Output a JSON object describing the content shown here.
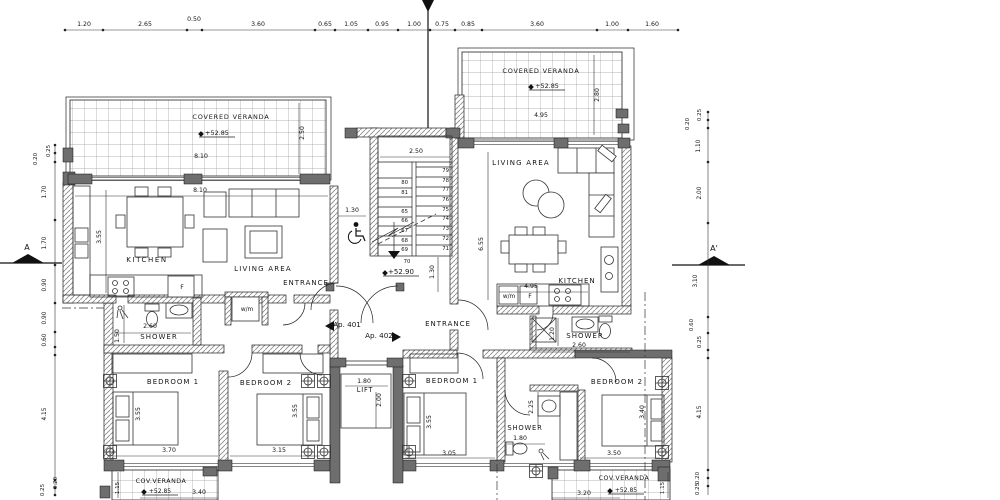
{
  "plan": {
    "type": "apartment-floor-plan",
    "apartment_left": "Ap. 401",
    "apartment_right": "Ap. 402",
    "section_marker_left": "A",
    "section_marker_right": "A'"
  },
  "stairs": {
    "left": [
      "80",
      "81",
      "65",
      "66",
      "67",
      "68",
      "69"
    ],
    "right": [
      "79",
      "78",
      "77",
      "76",
      "75",
      "74",
      "73",
      "72",
      "71"
    ],
    "bottom_step": "70"
  },
  "chains": {
    "top": {
      "y": 30,
      "x1": 65,
      "x2": 678,
      "dots": [
        65,
        103,
        187,
        202,
        315,
        335,
        368,
        398,
        430,
        455,
        482,
        597,
        628,
        678
      ]
    },
    "left": {
      "x": 55,
      "y1": 145,
      "y2": 496,
      "dots": [
        145,
        153,
        162,
        220,
        265,
        303,
        332,
        347,
        355,
        480,
        488,
        495
      ]
    },
    "right": {
      "x": 708,
      "y1": 112,
      "y2": 495,
      "dots": [
        112,
        120,
        128,
        162,
        223,
        317,
        333,
        350,
        358,
        470,
        478,
        486
      ]
    }
  },
  "labels": [
    {
      "t": "1.20",
      "x": 84,
      "y": 26
    },
    {
      "t": "2.65",
      "x": 145,
      "y": 26
    },
    {
      "t": "0.50",
      "x": 194,
      "y": 21
    },
    {
      "t": "3.60",
      "x": 258,
      "y": 26
    },
    {
      "t": "0.65",
      "x": 325,
      "y": 26
    },
    {
      "t": "1.05",
      "x": 351,
      "y": 26
    },
    {
      "t": "0.95",
      "x": 382,
      "y": 26
    },
    {
      "t": "1.00",
      "x": 414,
      "y": 26
    },
    {
      "t": "0.75",
      "x": 442,
      "y": 26
    },
    {
      "t": "0.85",
      "x": 468,
      "y": 26
    },
    {
      "t": "3.60",
      "x": 537,
      "y": 26
    },
    {
      "t": "1.00",
      "x": 612,
      "y": 26
    },
    {
      "t": "1.60",
      "x": 652,
      "y": 26
    },
    {
      "t": "0.25",
      "x": 50,
      "y": 151,
      "r": 1,
      "fs": 5.5
    },
    {
      "t": "0.20",
      "x": 37,
      "y": 159,
      "r": 1,
      "fs": 5.5
    },
    {
      "t": "1.70",
      "x": 46,
      "y": 192,
      "r": 1,
      "fs": 5.8
    },
    {
      "t": "1.70",
      "x": 46,
      "y": 243,
      "r": 1,
      "fs": 5.8
    },
    {
      "t": "0.90",
      "x": 46,
      "y": 285,
      "r": 1,
      "fs": 5.8
    },
    {
      "t": "0.90",
      "x": 46,
      "y": 318,
      "r": 1,
      "fs": 5.8
    },
    {
      "t": "0.60",
      "x": 46,
      "y": 340,
      "r": 1,
      "fs": 5.8
    },
    {
      "t": "4.15",
      "x": 46,
      "y": 414,
      "r": 1,
      "fs": 5.8
    },
    {
      "t": "0.20",
      "x": 57,
      "y": 483,
      "r": 1,
      "fs": 5.5
    },
    {
      "t": "0.25",
      "x": 44,
      "y": 490,
      "r": 1,
      "fs": 5.5
    },
    {
      "t": "0.25",
      "x": 701,
      "y": 115,
      "r": 1,
      "fs": 5.5
    },
    {
      "t": "0.20",
      "x": 689,
      "y": 124,
      "r": 1,
      "fs": 5.5
    },
    {
      "t": "1.10",
      "x": 700,
      "y": 146,
      "r": 1,
      "fs": 5.8
    },
    {
      "t": "2.00",
      "x": 701,
      "y": 193,
      "r": 1,
      "fs": 5.8
    },
    {
      "t": "3.10",
      "x": 697,
      "y": 281,
      "r": 1,
      "fs": 5.8
    },
    {
      "t": "0.60",
      "x": 693,
      "y": 325,
      "r": 1,
      "fs": 5.5
    },
    {
      "t": "0.25",
      "x": 701,
      "y": 342,
      "r": 1,
      "fs": 5.5
    },
    {
      "t": "4.15",
      "x": 701,
      "y": 412,
      "r": 1,
      "fs": 5.8
    },
    {
      "t": "0.20",
      "x": 699,
      "y": 478,
      "r": 1,
      "fs": 5.5
    },
    {
      "t": "0.25",
      "x": 699,
      "y": 489,
      "r": 1,
      "fs": 5.5
    },
    {
      "t": "A",
      "x": 27,
      "y": 250,
      "fs": 8,
      "n": "section-marker-a"
    },
    {
      "t": "A'",
      "x": 714,
      "y": 251,
      "fs": 8,
      "n": "section-marker-a-prime"
    },
    {
      "t": "COVERED VERANDA",
      "x": 231,
      "y": 119,
      "fs": 6.5,
      "ls": 0.8,
      "n": "label-covered-veranda-left"
    },
    {
      "t": "+52.85",
      "x": 217,
      "y": 135,
      "fs": 6.4,
      "lvl": 1,
      "n": "level-mark"
    },
    {
      "t": "8.10",
      "x": 201,
      "y": 158
    },
    {
      "t": "8.10",
      "x": 200,
      "y": 192
    },
    {
      "t": "2.50",
      "x": 304,
      "y": 133,
      "r": 1
    },
    {
      "t": "KITCHEN",
      "x": 147,
      "y": 262,
      "fs": 7,
      "ls": 1.6,
      "n": "label-kitchen-left"
    },
    {
      "t": "LIVING AREA",
      "x": 263,
      "y": 271,
      "fs": 7,
      "ls": 1.2,
      "n": "label-living-area-left"
    },
    {
      "t": "ENTRANCE",
      "x": 306,
      "y": 285,
      "fs": 7,
      "ls": 1.0,
      "n": "label-entrance-left"
    },
    {
      "t": "3.55",
      "x": 101,
      "y": 237,
      "r": 1
    },
    {
      "t": "2.60",
      "x": 150,
      "y": 328
    },
    {
      "t": "SHOWER",
      "x": 159,
      "y": 339,
      "fs": 7,
      "ls": 1.0,
      "n": "label-shower-left"
    },
    {
      "t": "1.50",
      "x": 119,
      "y": 336,
      "r": 1
    },
    {
      "t": "w/m",
      "x": 247,
      "y": 311,
      "fs": 5.8,
      "n": "label-washing-machine-left"
    },
    {
      "t": "F",
      "x": 182,
      "y": 289,
      "fs": 6.2,
      "n": "label-fridge-left"
    },
    {
      "t": "BEDROOM 1",
      "x": 173,
      "y": 384,
      "fs": 7,
      "ls": 1.0,
      "n": "label-bedroom1-left"
    },
    {
      "t": "BEDROOM 2",
      "x": 266,
      "y": 385,
      "fs": 7,
      "ls": 1.0,
      "n": "label-bedroom2-left"
    },
    {
      "t": "3.55",
      "x": 140,
      "y": 414,
      "r": 1
    },
    {
      "t": "3.70",
      "x": 169,
      "y": 452
    },
    {
      "t": "3.55",
      "x": 297,
      "y": 411,
      "r": 1
    },
    {
      "t": "3.15",
      "x": 279,
      "y": 452
    },
    {
      "t": "COV.VERANDA",
      "x": 161,
      "y": 483,
      "fs": 6.3,
      "ls": 0.5,
      "n": "label-cov-veranda-left"
    },
    {
      "t": "+52.85",
      "x": 160,
      "y": 493,
      "fs": 6,
      "lvl": 1,
      "n": "level-mark"
    },
    {
      "t": "1.15",
      "x": 119,
      "y": 488,
      "r": 1,
      "fs": 5.5
    },
    {
      "t": "3.40",
      "x": 199,
      "y": 494
    },
    {
      "t": "2.50",
      "x": 416,
      "y": 153
    },
    {
      "t": "1.30",
      "x": 352,
      "y": 212
    },
    {
      "t": "1.30",
      "x": 434,
      "y": 272,
      "r": 1
    },
    {
      "t": "+52.90",
      "x": 401,
      "y": 274,
      "fs": 7,
      "lvl": 1,
      "n": "level-mark"
    },
    {
      "t": "70",
      "x": 407,
      "y": 263,
      "fs": 5.3,
      "n": "stair-step-number"
    },
    {
      "t": "Ap. 401",
      "x": 347,
      "y": 327,
      "fs": 7.2,
      "n": "label-apartment-401"
    },
    {
      "t": "Ap. 402",
      "x": 379,
      "y": 338,
      "fs": 7.2,
      "n": "label-apartment-402"
    },
    {
      "t": "ENTRANCE",
      "x": 448,
      "y": 326,
      "fs": 7,
      "ls": 1.0,
      "n": "label-entrance-right"
    },
    {
      "t": "LIFT",
      "x": 365,
      "y": 392,
      "fs": 6.6,
      "ls": 0.8,
      "n": "label-lift"
    },
    {
      "t": "1.80",
      "x": 364,
      "y": 383
    },
    {
      "t": "2.00",
      "x": 381,
      "y": 400,
      "r": 1
    },
    {
      "t": "COVERED VERANDA",
      "x": 541,
      "y": 73,
      "fs": 6.5,
      "ls": 0.8,
      "n": "label-covered-veranda-right"
    },
    {
      "t": "+52.85",
      "x": 547,
      "y": 88,
      "fs": 6.4,
      "lvl": 1,
      "n": "level-mark"
    },
    {
      "t": "4.95",
      "x": 541,
      "y": 117
    },
    {
      "t": "2.80",
      "x": 599,
      "y": 95,
      "r": 1
    },
    {
      "t": "LIVING AREA",
      "x": 521,
      "y": 165,
      "fs": 7,
      "ls": 1.2,
      "n": "label-living-area-right"
    },
    {
      "t": "6.55",
      "x": 483,
      "y": 244,
      "r": 1
    },
    {
      "t": "4.95",
      "x": 531,
      "y": 288
    },
    {
      "t": "KITCHEN",
      "x": 577,
      "y": 283,
      "fs": 7,
      "ls": 1.0,
      "n": "label-kitchen-right"
    },
    {
      "t": "w/m",
      "x": 509,
      "y": 298,
      "fs": 5.8,
      "n": "label-washing-machine-right"
    },
    {
      "t": "F",
      "x": 530,
      "y": 298,
      "fs": 6.2,
      "n": "label-fridge-right"
    },
    {
      "t": "SHOWER",
      "x": 585,
      "y": 338,
      "fs": 7,
      "ls": 1.0,
      "n": "label-shower-right-1"
    },
    {
      "t": "2.60",
      "x": 579,
      "y": 347
    },
    {
      "t": "1.20",
      "x": 554,
      "y": 334,
      "r": 1
    },
    {
      "t": "BEDROOM 1",
      "x": 452,
      "y": 383,
      "fs": 7,
      "ls": 1.0,
      "n": "label-bedroom1-right"
    },
    {
      "t": "3.55",
      "x": 431,
      "y": 422,
      "r": 1
    },
    {
      "t": "3.05",
      "x": 449,
      "y": 455
    },
    {
      "t": "SHOWER",
      "x": 525,
      "y": 430,
      "fs": 6.8,
      "ls": 0.8,
      "n": "label-shower-right-2"
    },
    {
      "t": "1.80",
      "x": 520,
      "y": 440
    },
    {
      "t": "2.25",
      "x": 533,
      "y": 407,
      "r": 1
    },
    {
      "t": "BEDROOM 2",
      "x": 617,
      "y": 384,
      "fs": 7,
      "ls": 1.0,
      "n": "label-bedroom2-right"
    },
    {
      "t": "3.40",
      "x": 644,
      "y": 412,
      "r": 1
    },
    {
      "t": "3.50",
      "x": 614,
      "y": 455
    },
    {
      "t": "COV.VERANDA",
      "x": 624,
      "y": 480,
      "fs": 6.3,
      "ls": 0.5,
      "n": "label-cov-veranda-right"
    },
    {
      "t": "+52.85",
      "x": 626,
      "y": 492,
      "fs": 6,
      "lvl": 1,
      "n": "level-mark"
    },
    {
      "t": "3.20",
      "x": 584,
      "y": 495
    },
    {
      "t": "1.15",
      "x": 664,
      "y": 488,
      "r": 1,
      "fs": 5.5
    }
  ]
}
